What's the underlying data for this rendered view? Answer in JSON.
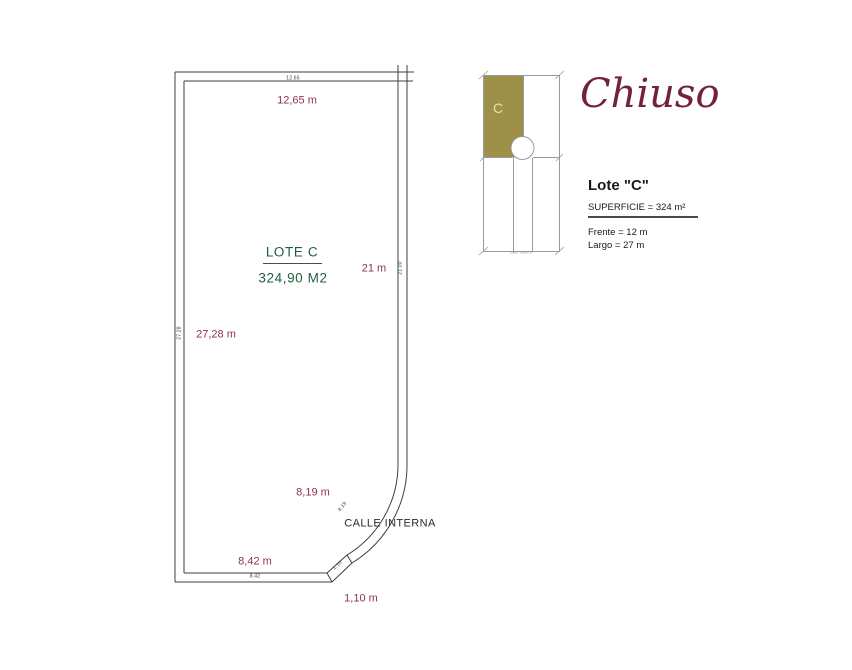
{
  "plan": {
    "lot_title": "LOTE C",
    "lot_area": "324,90 M2",
    "street": "CALLE INTERNA",
    "dimensions": {
      "top_label": "12,65 m",
      "top_tick": "12.65",
      "left_label": "27,28 m",
      "left_tick": "27.28",
      "right_label": "21 m",
      "right_tick": "21.00",
      "curve_label": "8,19 m",
      "curve_tick": "8.19",
      "bottom_label": "8,42 m",
      "bottom_tick": "8.42",
      "chamfer_label": "1,10 m",
      "chamfer_tick": "1.10"
    }
  },
  "sidebar": {
    "brand": "Chiuso",
    "key_map": {
      "lot_letter": "C",
      "caption": "calle interna"
    },
    "details": {
      "title": "Lote \"C\"",
      "area_line": "SUPERFICIE = 324 m²",
      "front_line": "Frente = 12 m",
      "depth_line": "Largo = 27 m"
    }
  },
  "colors": {
    "dimension_red": "#8e3243",
    "lot_green": "#215e3f",
    "brand_maroon": "#72233a",
    "map_olive": "#9d9048",
    "map_letter_cream": "#e6e0ac",
    "plan_line": "#3f3f3f",
    "map_line": "#9a9a9a"
  }
}
